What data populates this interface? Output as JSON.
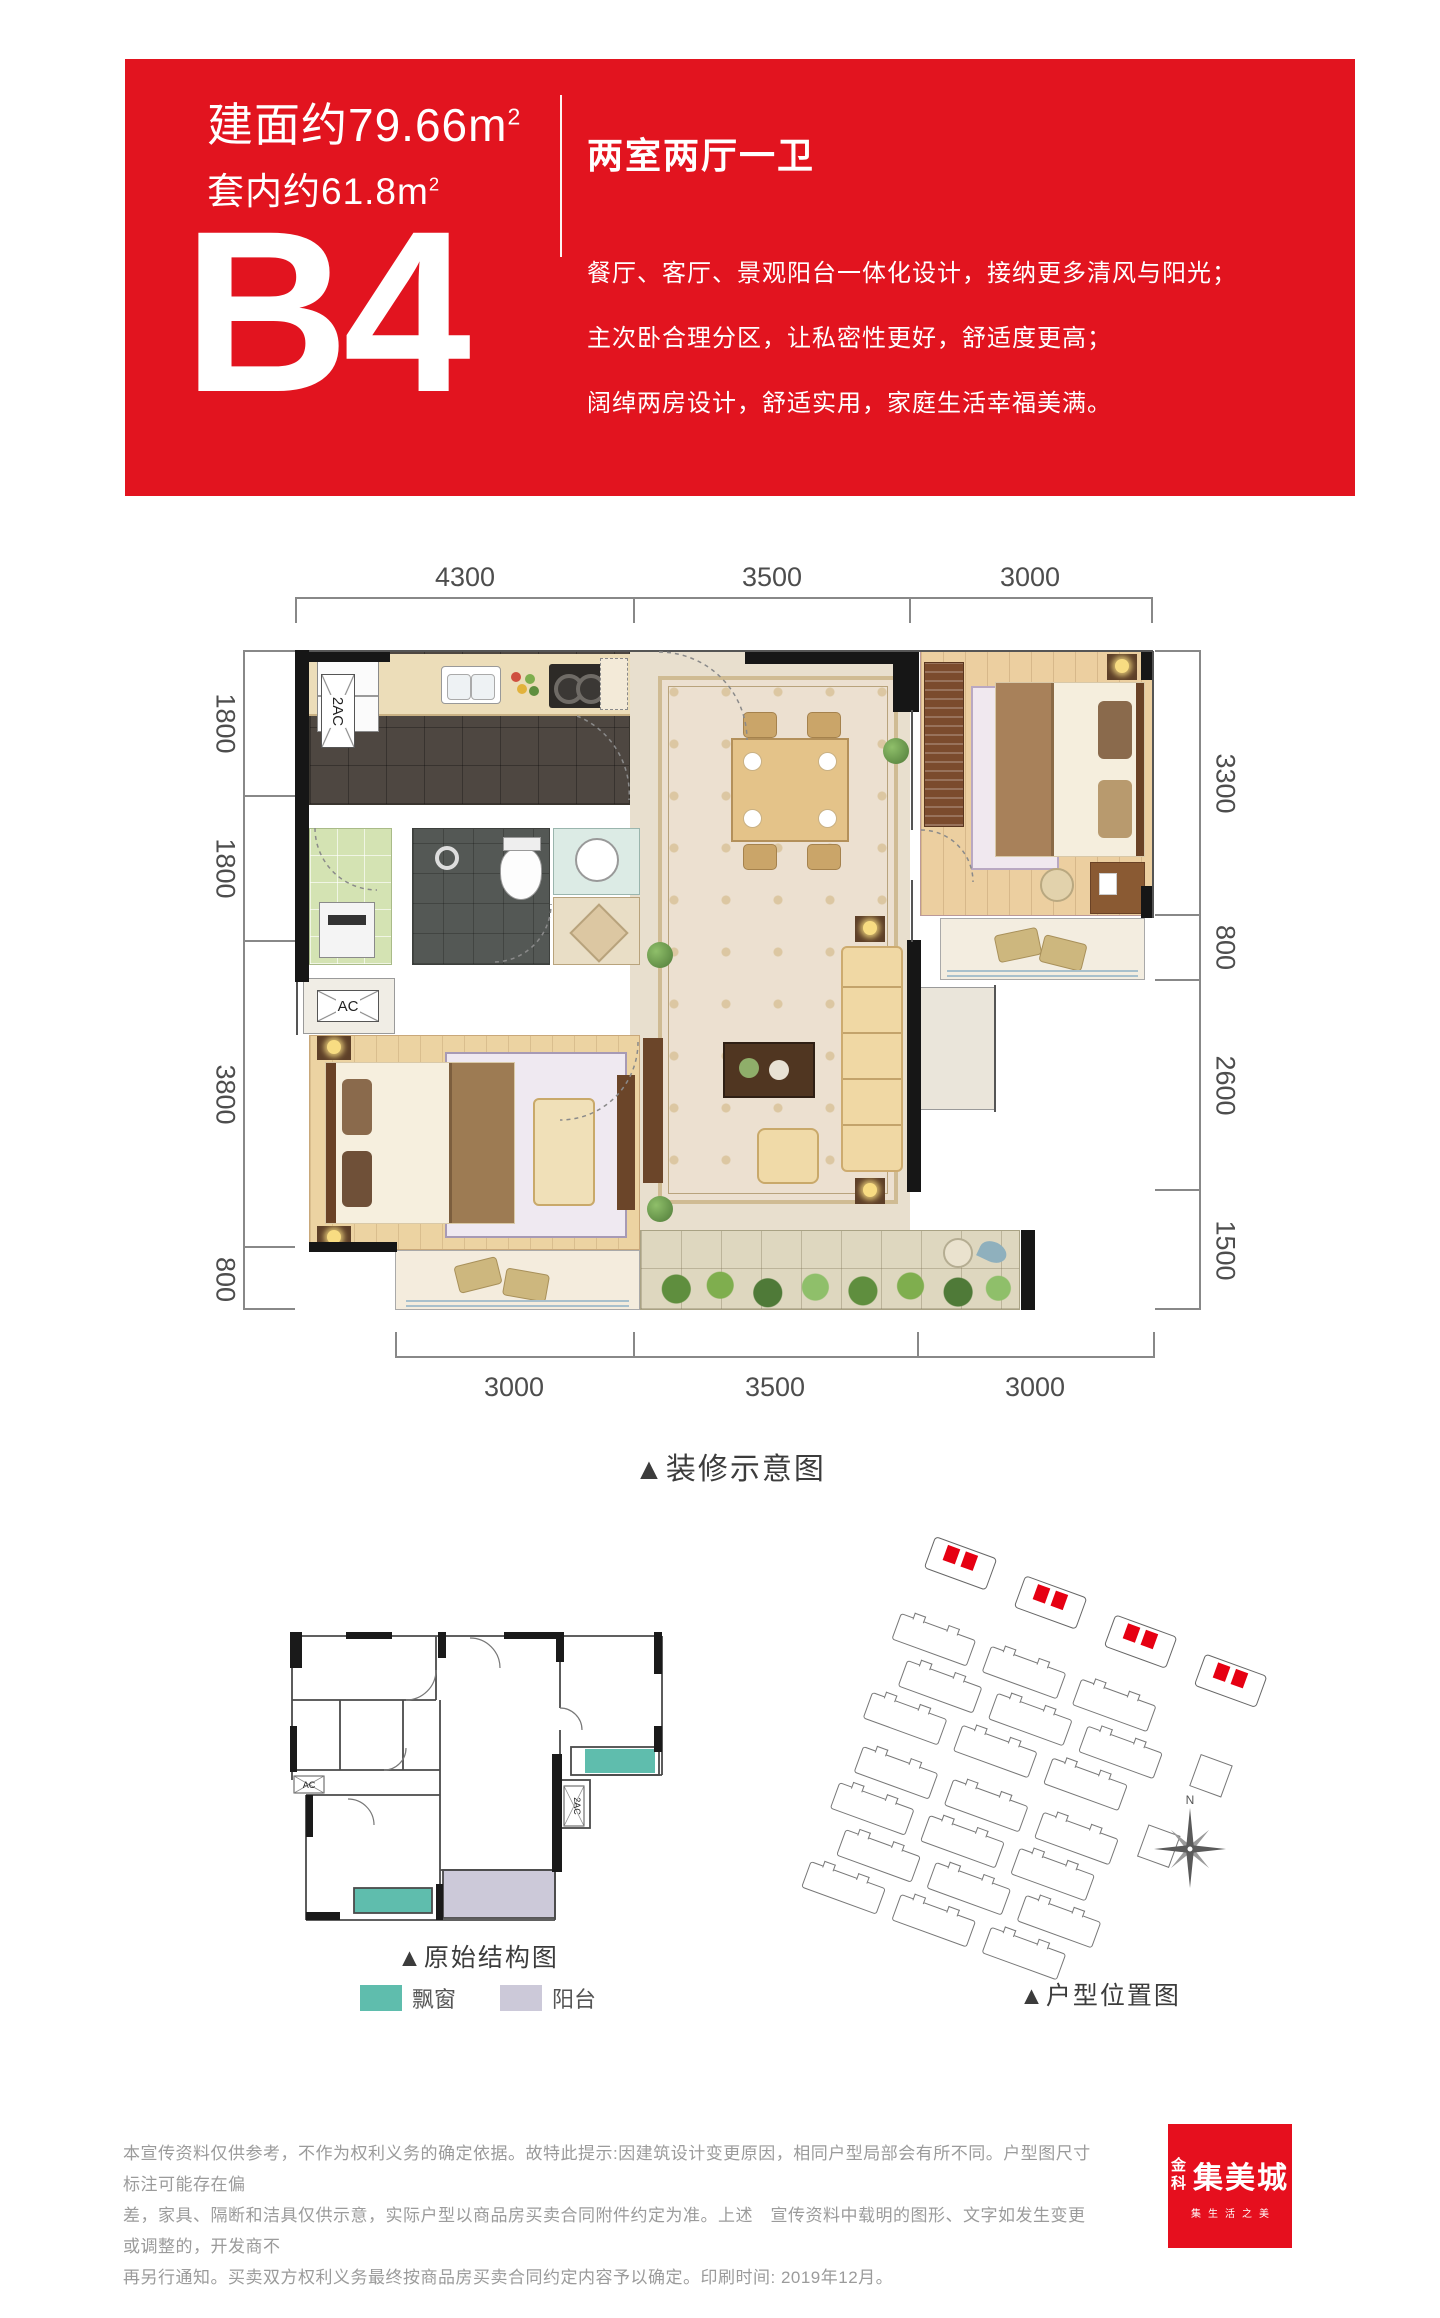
{
  "header": {
    "area_built_label": "建面约79.66m",
    "area_built_sup": "2",
    "area_inner_label": "套内约61.8m",
    "area_inner_sup": "2",
    "layout_type": "两室两厅一卫",
    "unit_code": "B4",
    "desc_lines": [
      "餐厅、客厅、景观阳台一体化设计，接纳更多清风与阳光；",
      "主次卧合理分区，让私密性更好，舒适度更高；",
      "阔绰两房设计，舒适实用，家庭生活幸福美满。"
    ],
    "bg_color": "#e2141f"
  },
  "floor_plan": {
    "caption": "▲装修示意图",
    "dims_top": [
      "4300",
      "3500",
      "3000"
    ],
    "dims_left": [
      "1800",
      "1800",
      "3800",
      "800"
    ],
    "dims_right": [
      "3300",
      "800",
      "2600",
      "1500"
    ],
    "dims_bottom": [
      "3000",
      "3500",
      "3000"
    ],
    "ac_label": "AC",
    "ac2_label": "2AC"
  },
  "structure_plan": {
    "caption": "▲原始结构图",
    "ac_label": "AC",
    "ac2_label": "2AC",
    "legend": [
      {
        "label": "飘窗",
        "color": "#5fbdad"
      },
      {
        "label": "阳台",
        "color": "#ccc9d9"
      }
    ]
  },
  "site_plan": {
    "caption": "▲户型位置图",
    "compass_north": "N",
    "highlight_color": "#e60012"
  },
  "footer": {
    "disclaimer_lines": [
      "本宣传资料仅供参考，不作为权利义务的确定依据。故特此提示:因建筑设计变更原因，相同户型局部会有所不同。户型图尺寸标注可能存在偏",
      "差，家具、隔断和洁具仅供示意，实际户型以商品房买卖合同附件约定为准。上述　宣传资料中载明的图形、文字如发生变更或调整的，开发商不",
      "再另行通知。买卖双方权利义务最终按商品房买卖合同约定内容予以确定。印刷时间: 2019年12月。"
    ],
    "logo": {
      "brand_small": "金科",
      "brand_large": "集美城",
      "tagline": "集生活之美"
    }
  }
}
